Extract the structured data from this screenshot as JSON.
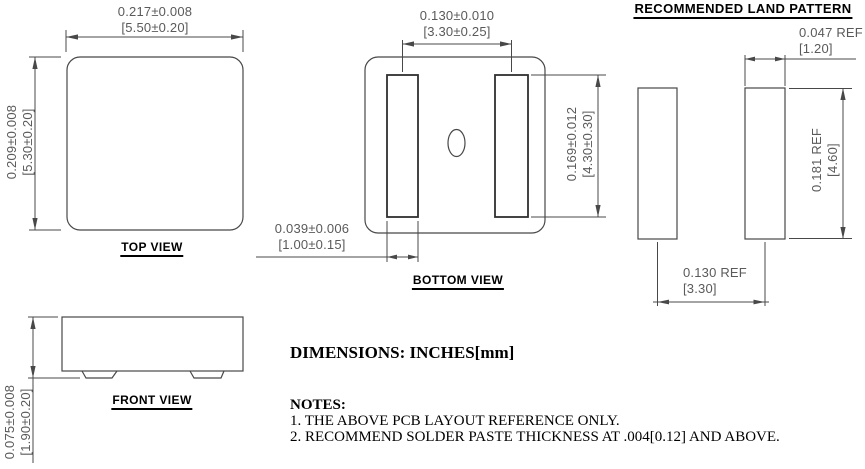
{
  "colors": {
    "line": "#484848",
    "pad_line": "#303030",
    "dim_text": "#5a5a5a",
    "label_text": "#000000",
    "background": "#ffffff"
  },
  "land_pattern": {
    "title": "RECOMMENDED LAND PATTERN",
    "dim_pad_width_in": "0.047  REF",
    "dim_pad_width_mm": "[1.20]",
    "dim_pad_height_in": "0.181  REF",
    "dim_pad_height_mm": "[4.60]",
    "dim_pad_pitch_in": "0.130  REF",
    "dim_pad_pitch_mm": "[3.30]"
  },
  "top_view": {
    "label": "TOP VIEW",
    "dim_width_in": "0.217±0.008",
    "dim_width_mm": "[5.50±0.20]",
    "dim_height_in": "0.209±0.008",
    "dim_height_mm": "[5.30±0.20]"
  },
  "bottom_view": {
    "label": "BOTTOM VIEW",
    "dim_pad_pitch_in": "0.130±0.010",
    "dim_pad_pitch_mm": "[3.30±0.25]",
    "dim_pad_height_in": "0.169±0.012",
    "dim_pad_height_mm": "[4.30±0.30]",
    "dim_pad_width_in": "0.039±0.006",
    "dim_pad_width_mm": "[1.00±0.15]"
  },
  "front_view": {
    "label": "FRONT VIEW",
    "dim_height_in": "0.075±0.008",
    "dim_height_mm": "[1.90±0.20]"
  },
  "footer": {
    "dimensions_note": "DIMENSIONS: INCHES[mm]",
    "notes_title": "NOTES:",
    "note_1": "1. THE ABOVE PCB LAYOUT REFERENCE ONLY.",
    "note_2": "2. RECOMMEND SOLDER PASTE THICKNESS AT .004[0.12] AND ABOVE."
  }
}
